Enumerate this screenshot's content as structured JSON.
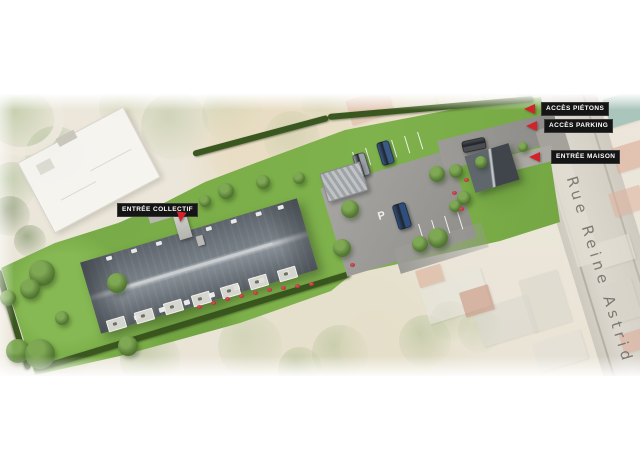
{
  "annotations": {
    "entree_collectif": "ENTRÉE COLLECTIF",
    "acces_pietons": "ACCÈS PIÉTONS",
    "acces_parking": "ACCÈS PARKING",
    "entree_maison": "ENTRÉE MAISON"
  },
  "street": {
    "name": "Rue Reine Astrid"
  },
  "parking": {
    "pavement_letter": "P"
  },
  "colors": {
    "annotation_badge_bg": "#151515",
    "annotation_badge_text": "#ffffff",
    "annotation_arrow_red": "#d2232a",
    "site_lawn_green": "#7cae4a",
    "main_roof_slate": "#676e75",
    "house_roof_dark": "#474d53",
    "street_pavement": "#d6d2c8",
    "street_name_text": "#68645f"
  }
}
